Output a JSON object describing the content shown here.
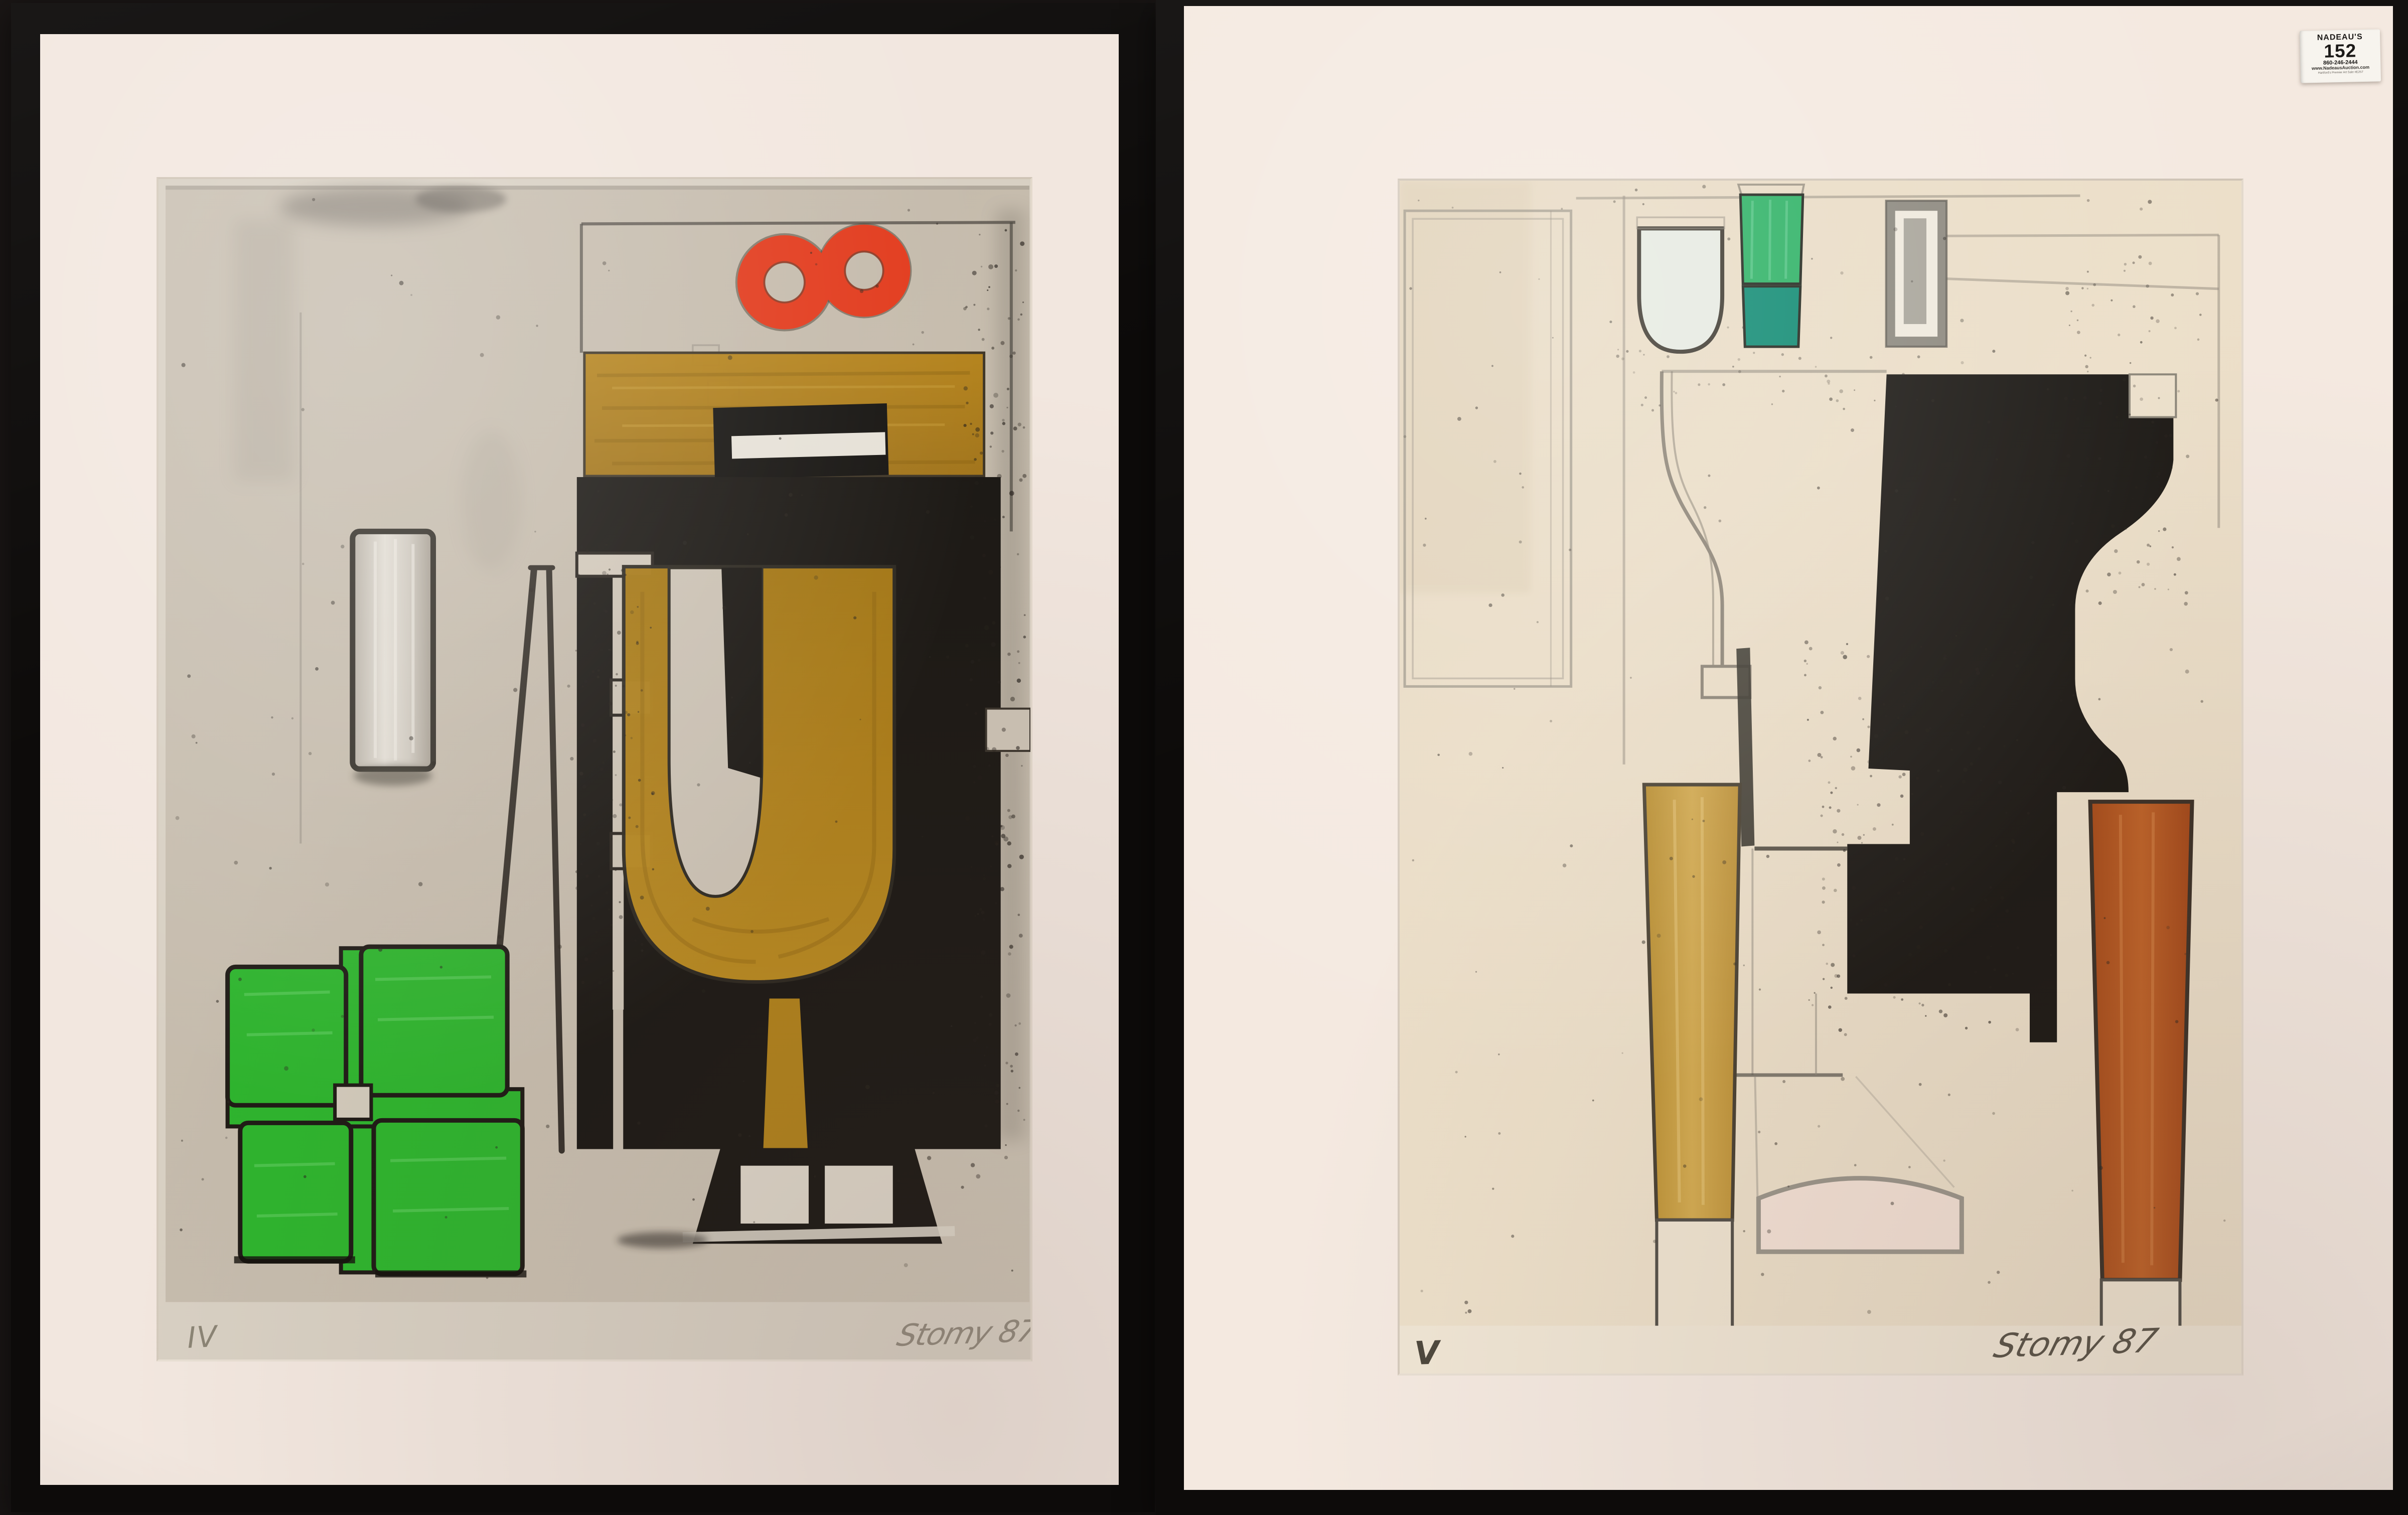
{
  "auction_tag": {
    "house": "NADEAU'S",
    "lot_number": "152",
    "phone": "860-246-2444",
    "website": "www.NadeausAuction.com",
    "sale_line": "Hartford's Premier Art Sale #E257"
  },
  "left_artwork": {
    "edition_mark": "IV",
    "signature": "Stomy 87",
    "media_note_colors": {
      "paper": "#c7bdae",
      "ochre": "#b07f1c",
      "red": "#e23b1d",
      "green": "#2eb42e",
      "black": "#1c1915"
    }
  },
  "right_artwork": {
    "edition_mark": "V",
    "signature": "Stomy 87",
    "media_note_colors": {
      "paper": "#e9dcc6",
      "bright_green": "#2cb164",
      "teal": "#0e8a72",
      "ochre_column": "#c69b3f",
      "rust_column": "#b0531e",
      "black": "#1c1915"
    }
  },
  "palette": {
    "frame": "#0d0b0a",
    "mat_left": "#f2e7df",
    "mat_right": "#f4e9e0",
    "pencil": "#55504a"
  }
}
